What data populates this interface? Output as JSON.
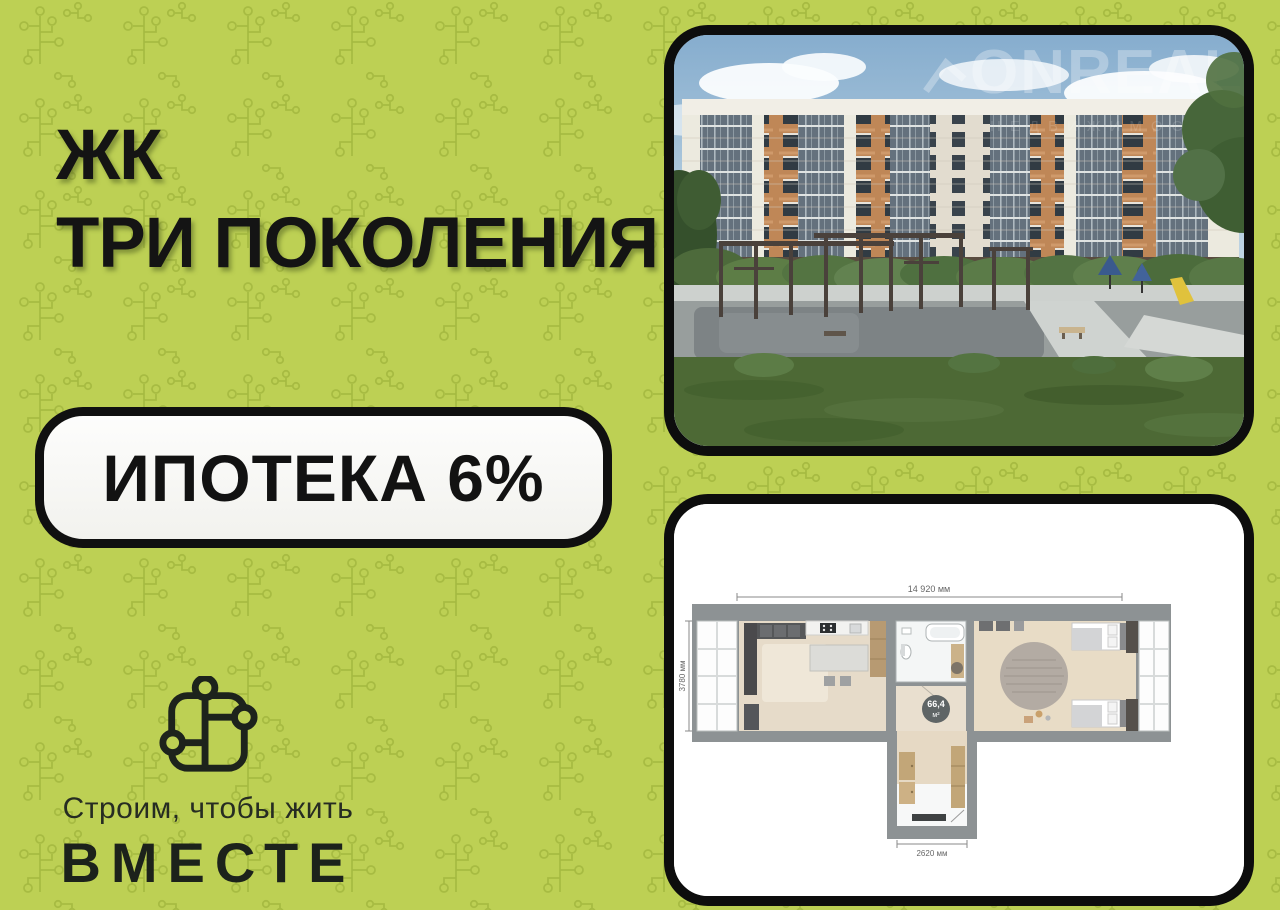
{
  "flyer": {
    "title_line1": "ЖК",
    "title_line2": "ТРИ ПОКОЛЕНИЯ",
    "badge_label": "ИПОТЕКА 6%"
  },
  "brand": {
    "tagline": "Строим, чтобы жить",
    "name": "ВМЕСТЕ"
  },
  "building_photo": {
    "watermark": "ONREAL",
    "watermark_sub": "НЕДВИЖИМОСТЬ"
  },
  "floorplan": {
    "area_value": "66,4",
    "area_unit": "м²",
    "dim_width_total": "14 920 мм",
    "dim_height_left": "3780 мм",
    "dim_width_hall": "2620 мм"
  },
  "colors": {
    "background": "#bdd054",
    "pattern": "#a4ba40",
    "text": "#141414",
    "frame_border": "#0d0d0d",
    "badge_bg": "#fbfbf9"
  }
}
